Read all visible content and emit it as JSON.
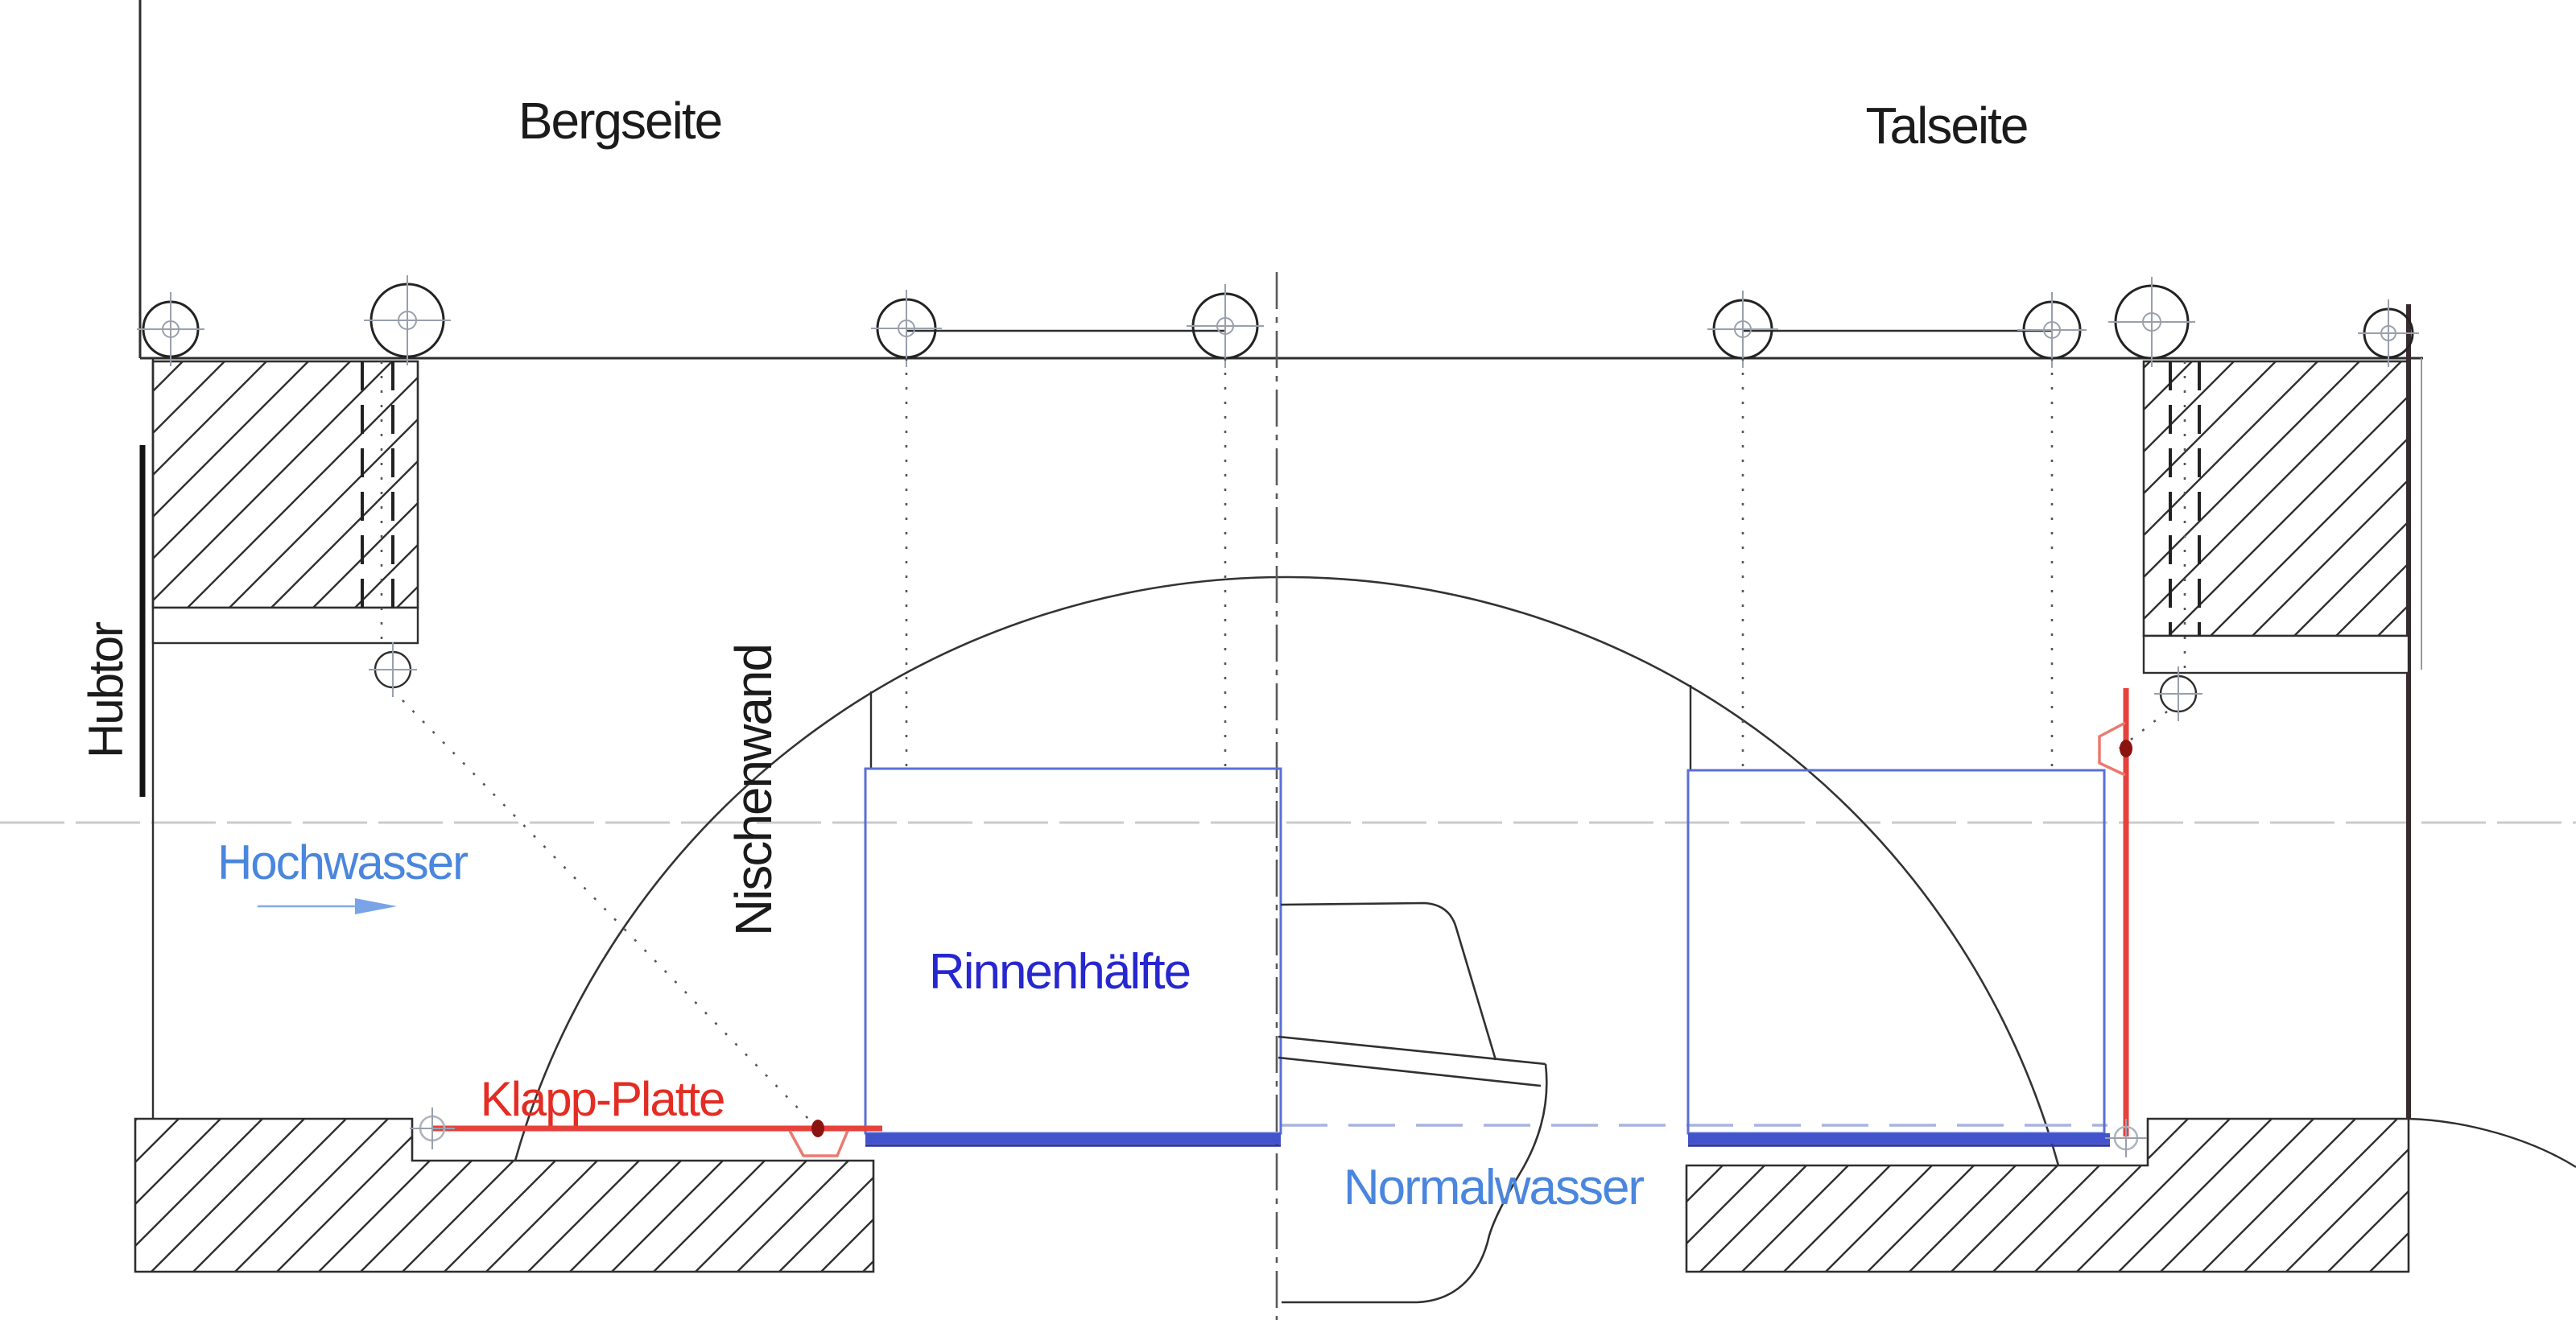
{
  "labels": {
    "bergseite": {
      "text": "Bergseite"
    },
    "talseite": {
      "text": "Talseite"
    },
    "hubtor": {
      "text": "Hubtor"
    },
    "nischenwand": {
      "text": "Nischenwand"
    },
    "hochwasser": {
      "text": "Hochwasser"
    },
    "rinnenhaelfte": {
      "text": "Rinnenhälfte"
    },
    "klapp_platte": {
      "text": "Klapp-Platte"
    },
    "normalwasser": {
      "text": "Normalwasser"
    }
  },
  "colors": {
    "line_dark": "#2e2e2e",
    "hatch": "#2f2f2f",
    "wall_dark": "#372b2d",
    "crosshair": "#98a0ac",
    "center_line": "#5a5a5a",
    "dotted": "#565656",
    "channel_blue": "#5a6fd6",
    "band_blue": "#4353cb",
    "band_edge_blue": "#2b36a8",
    "waterline_blue": "#a7b4dd",
    "water_level_gray": "#cbcbcb",
    "red": "#e6413b",
    "red_light": "#ea7a70",
    "red_dark": "#8c1410",
    "text_black": "#1b1b1b",
    "text_blue_dark": "#2727cf",
    "text_blue_light": "#4a86dd",
    "text_red": "#e32c23",
    "arrow_blue": "#7aa3e8"
  }
}
